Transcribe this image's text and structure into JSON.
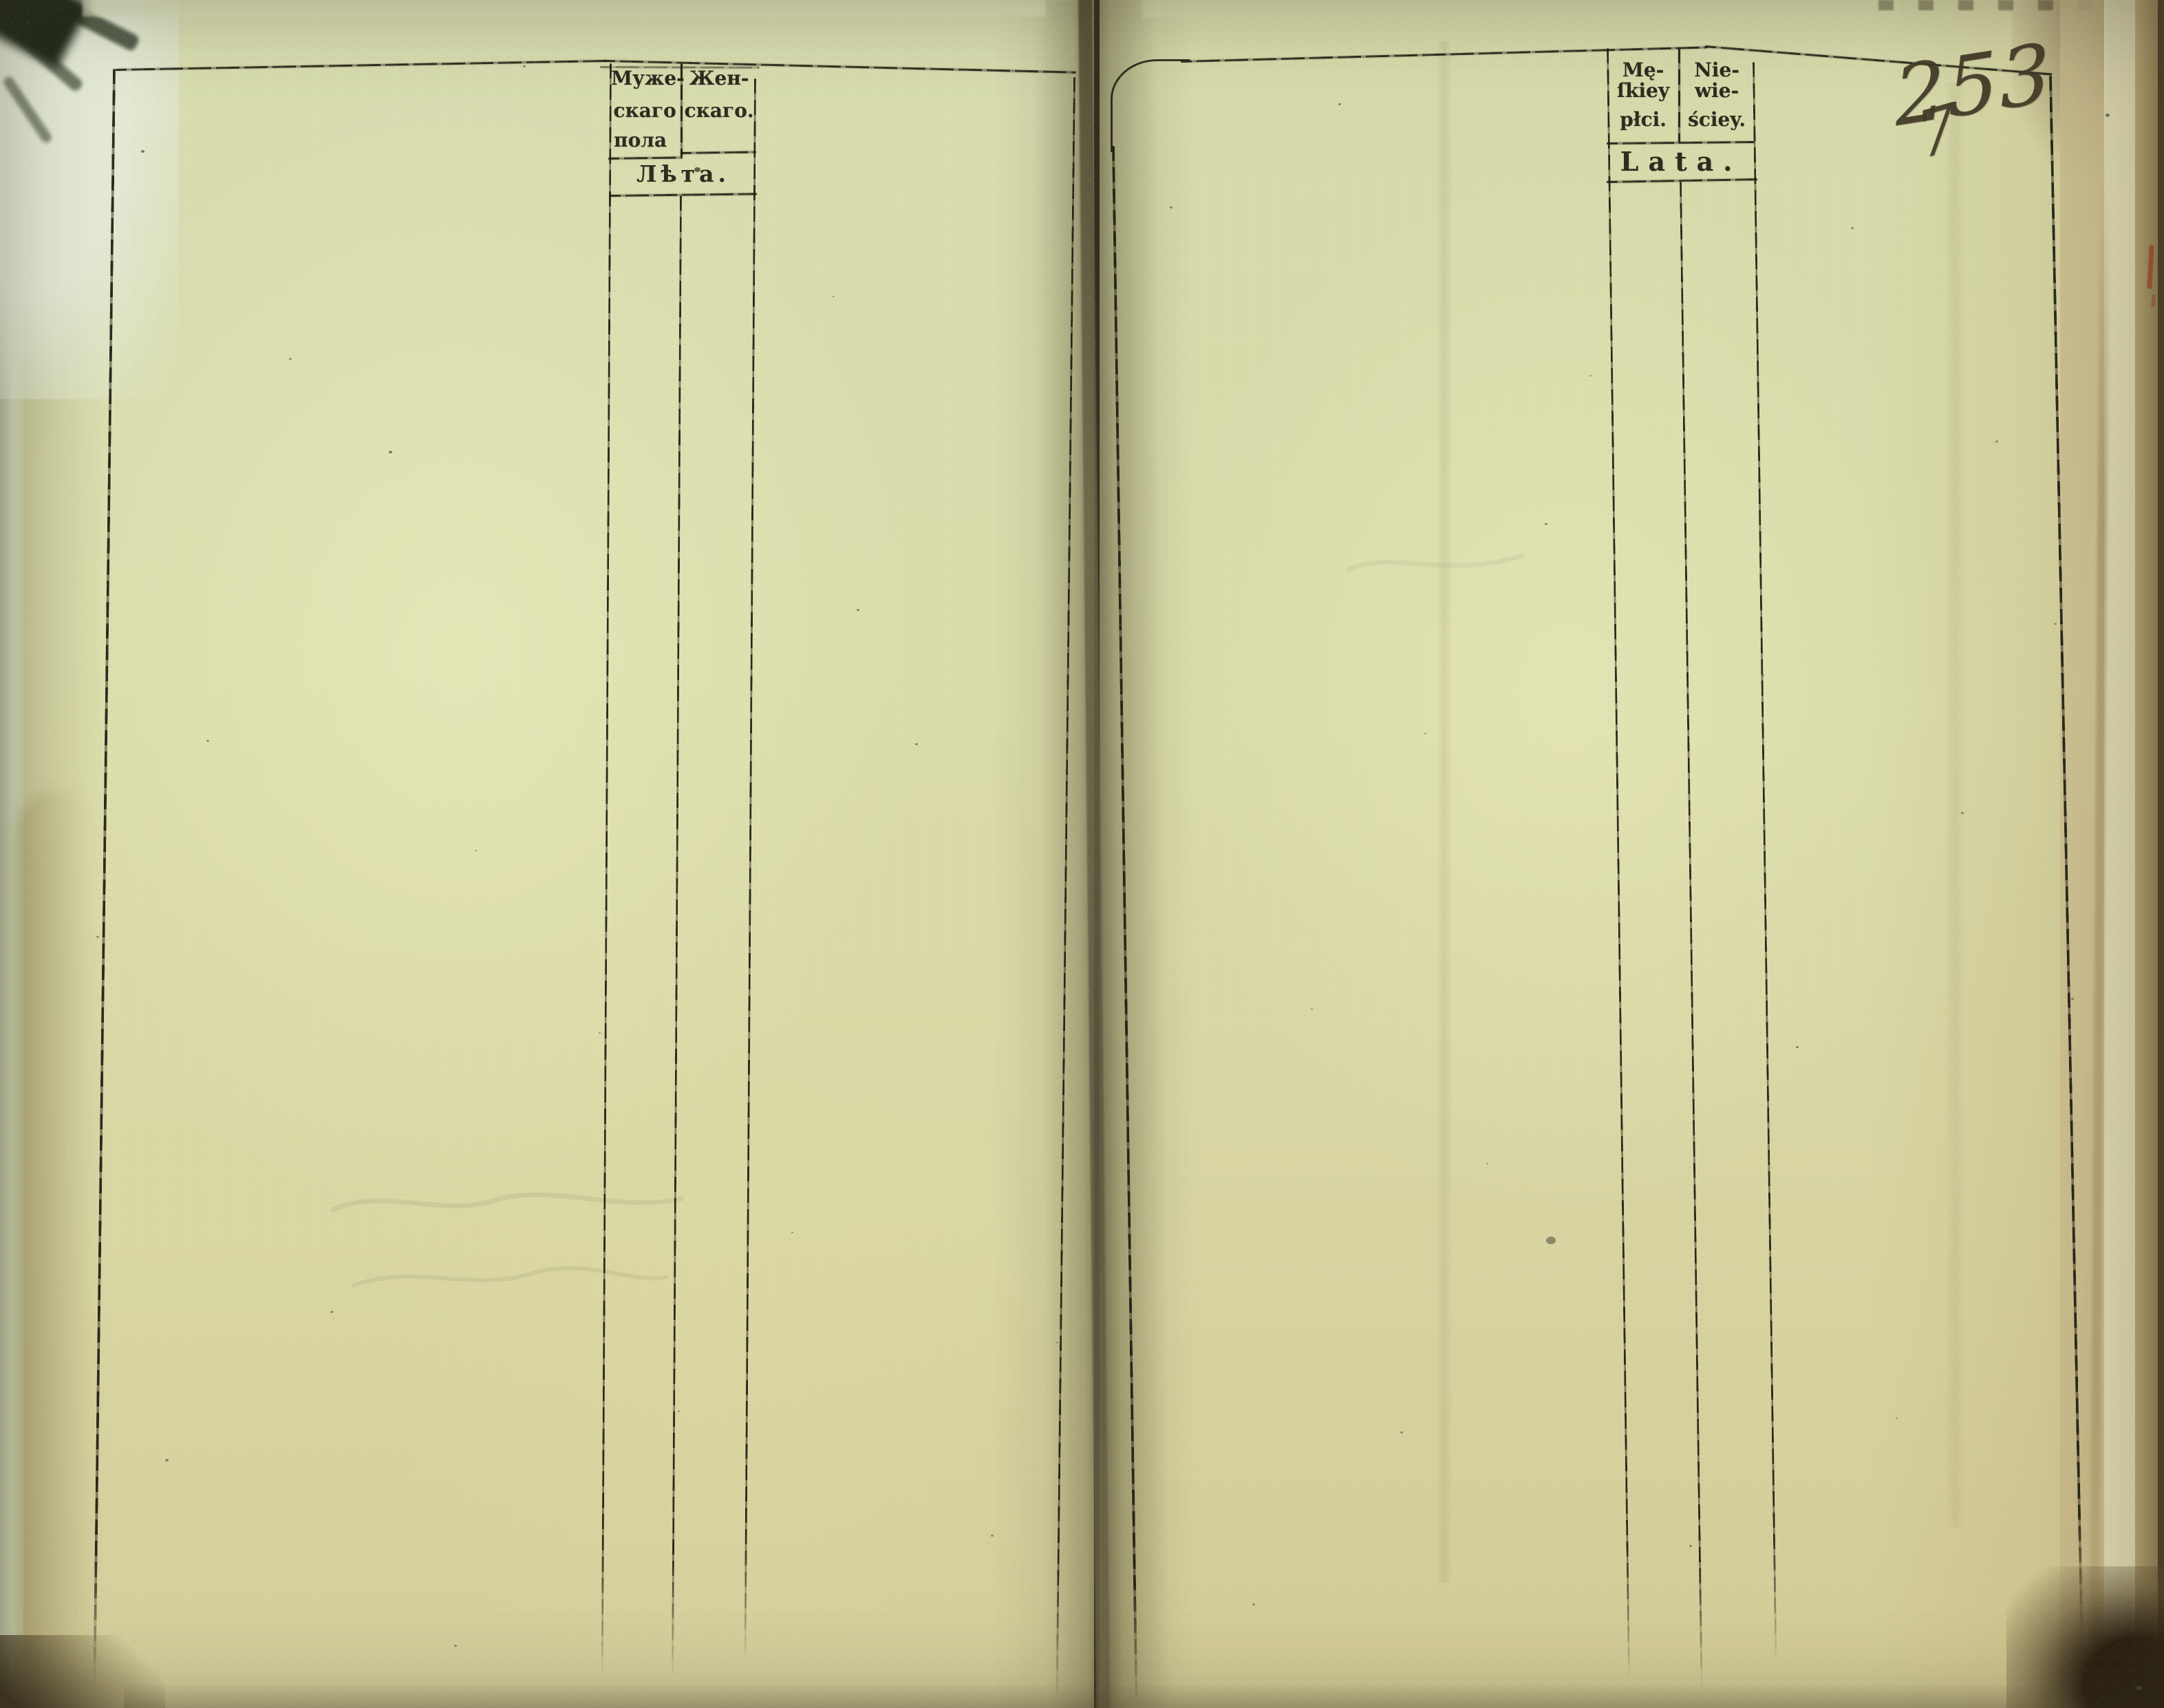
{
  "left_page": {
    "header": {
      "male_column": {
        "lines": [
          "Муже-",
          "скаго",
          "пола"
        ]
      },
      "female_column": {
        "lines": [
          "Жен-",
          "скаго."
        ]
      },
      "age_row": "Лѣта."
    }
  },
  "right_page": {
    "header": {
      "male_column": {
        "lines": [
          "Mę-",
          "ſkiey",
          "płci."
        ]
      },
      "female_column": {
        "lines": [
          "Nie-",
          "wie-",
          "ściey."
        ]
      },
      "age_row": "Lata."
    },
    "folio_number": "253",
    "folio_number_below": "7"
  },
  "colors": {
    "paper": "#d9dcab",
    "rule_ink": "#201e13",
    "print_ink": "#26241a",
    "handwriting_ink": "#403926",
    "red_mark": "#a0402c"
  }
}
